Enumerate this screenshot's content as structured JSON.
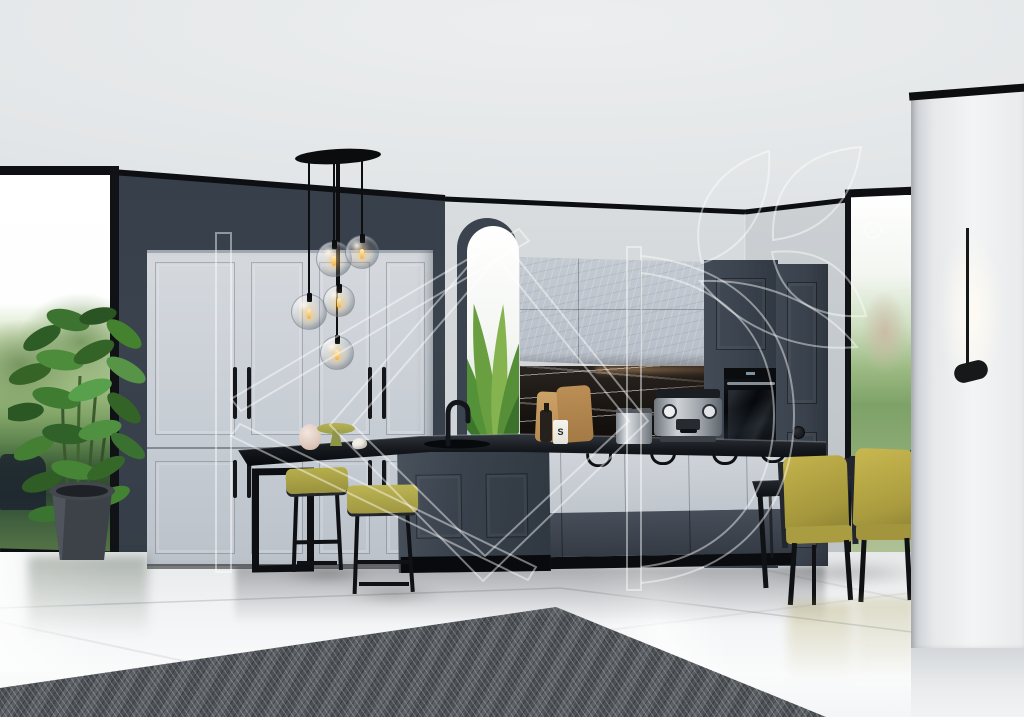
{
  "scene": {
    "title": "Photorealistic render of a modern two-tone kitchen and dining interior",
    "watermark": {
      "letters": "КД",
      "emblem": "leaf-branch-logo"
    },
    "counter_jar_label": "S",
    "palette": {
      "ceiling": "#e4e7e9",
      "dark_wall": "#39414d",
      "light_cabinet": "#ccd1d8",
      "charcoal_cabinet": "#3a424e",
      "black_counter": "#14171b",
      "backsplash_marble": "#1b1511",
      "olive_accent": "#b0a245",
      "floor_marble": "#f0f1f3",
      "rug": "#54585d",
      "foliage": "#3f7a33",
      "outdoor_green": "#86a569"
    },
    "objects": [
      "glass globe pendant cluster",
      "floor-to-ceiling left window",
      "tall light-gray wardrobe cabinets",
      "arched niche with plant",
      "textured upper cabinets",
      "black marble backsplash",
      "built-in oven",
      "espresso machine",
      "kitchen island with black faucet and sink",
      "breakfast bar with metal frame",
      "olive bar stools",
      "rubber-tree potted plant",
      "dark glass dining table",
      "olive dining chairs",
      "right window",
      "minimalist black wall lamp",
      "white marble column",
      "gray herringbone rug",
      "glossy marble floor"
    ]
  }
}
